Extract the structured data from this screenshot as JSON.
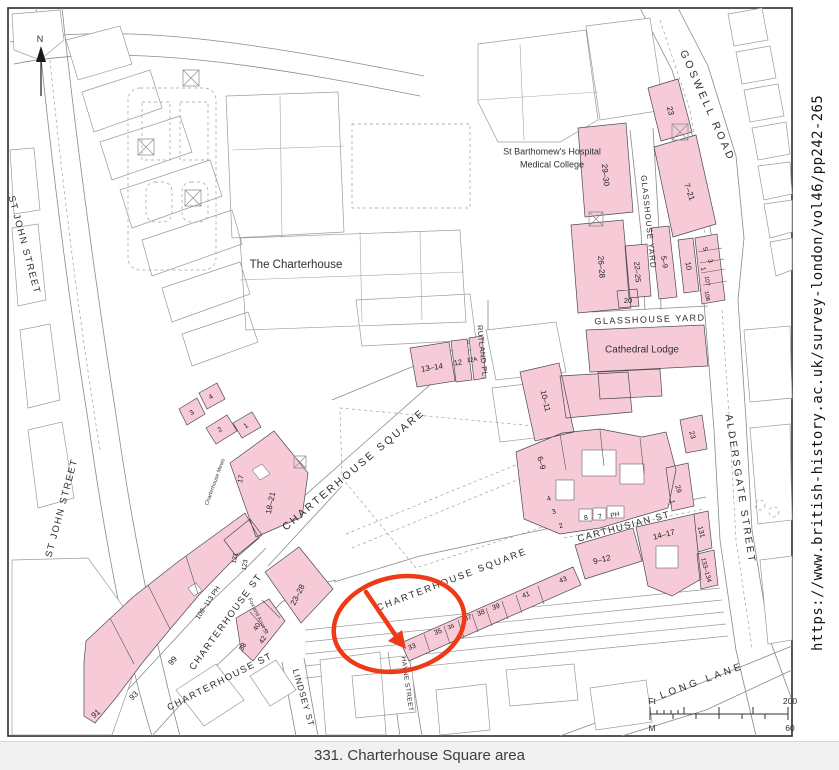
{
  "figure": {
    "caption": "331. Charterhouse Square area",
    "source_url": "https://www.british-history.ac.uk/survey-london/vol46/pp242-265"
  },
  "compass": {
    "north_label": "N"
  },
  "scale_bar": {
    "feet_unit": "Ft",
    "feet_max": "200",
    "meters_unit": "M",
    "meters_max": "60"
  },
  "colors": {
    "building_fill": "#f6cbd7",
    "annotation_red": "#ee3a17",
    "outline_gray": "#8a8a8a",
    "caption_bg": "#f1f1f2"
  },
  "map": {
    "labels": [
      {
        "t": "ST JOHN STREET",
        "x": 24,
        "y": 245,
        "r": 75,
        "s": 9.5,
        "ls": 1.5,
        "c": "st"
      },
      {
        "t": "ST JOHN STREET",
        "x": 62,
        "y": 508,
        "r": -75,
        "s": 9.5,
        "ls": 1.5,
        "c": "st"
      },
      {
        "t": "CHARTERHOUSE SQUARE",
        "x": 354,
        "y": 470,
        "r": -40,
        "s": 10.5,
        "ls": 2.5,
        "c": "st"
      },
      {
        "t": "CHARTERHOUSE SQUARE",
        "x": 452,
        "y": 580,
        "r": -21,
        "s": 9.5,
        "ls": 2,
        "c": "st"
      },
      {
        "t": "CHARTERHOUSE ST",
        "x": 226,
        "y": 622,
        "r": -54,
        "s": 9.5,
        "ls": 1.5,
        "c": "st"
      },
      {
        "t": "CHARTERHOUSE ST",
        "x": 220,
        "y": 682,
        "r": -27,
        "s": 9.5,
        "ls": 1.5,
        "c": "st"
      },
      {
        "t": "CARTHUSIAN ST",
        "x": 624,
        "y": 527,
        "r": -15,
        "s": 9.5,
        "ls": 1.5,
        "c": "st"
      },
      {
        "t": "ALDERSGATE STREET",
        "x": 740,
        "y": 489,
        "r": 81,
        "s": 10,
        "ls": 2.5,
        "c": "st"
      },
      {
        "t": "GOSWELL ROAD",
        "x": 707,
        "y": 106,
        "r": 66,
        "s": 10.5,
        "ls": 3,
        "c": "st"
      },
      {
        "t": "GLASSHOUSE YARD",
        "x": 648,
        "y": 222,
        "r": 84,
        "s": 8,
        "ls": 1,
        "c": "st"
      },
      {
        "t": "GLASSHOUSE YARD",
        "x": 650,
        "y": 320,
        "r": -2,
        "s": 9,
        "ls": 1.5,
        "c": "st"
      },
      {
        "t": "RUTLAND PL.",
        "x": 482,
        "y": 352,
        "r": 84,
        "s": 7.5,
        "ls": 0.5,
        "c": "st"
      },
      {
        "t": "LONG LANE",
        "x": 702,
        "y": 681,
        "r": -20,
        "s": 10,
        "ls": 3.5,
        "c": "st"
      },
      {
        "t": "LINDSEY ST",
        "x": 303,
        "y": 698,
        "r": 74,
        "s": 8.5,
        "ls": 1,
        "c": "st"
      },
      {
        "t": "HAYNE STREET",
        "x": 407,
        "y": 684,
        "r": 82,
        "s": 6.5,
        "ls": 0.5,
        "c": "st"
      },
      {
        "t": "Charterhouse Mews",
        "x": 215,
        "y": 482,
        "r": -70,
        "s": 5.5,
        "ls": 0,
        "c": "tiny"
      },
      {
        "t": "Fox and Knot St",
        "x": 258,
        "y": 616,
        "r": 64,
        "s": 5.5,
        "ls": 0,
        "c": "tiny"
      },
      {
        "t": "The Charterhouse",
        "x": 296,
        "y": 265,
        "r": 0,
        "s": 11.5,
        "ls": 0,
        "c": "pl"
      },
      {
        "t": "St Barthomew's Hospital",
        "x": 552,
        "y": 152,
        "r": 0,
        "s": 9,
        "ls": 0,
        "c": "pl"
      },
      {
        "t": "Medical College",
        "x": 552,
        "y": 165,
        "r": 0,
        "s": 9,
        "ls": 0,
        "c": "pl"
      },
      {
        "t": "Cathedral Lodge",
        "x": 642,
        "y": 350,
        "r": 0,
        "s": 10,
        "ls": 0,
        "c": "pl"
      },
      {
        "t": "23",
        "x": 670,
        "y": 111,
        "r": 75,
        "s": 8,
        "ls": 0,
        "c": "nm"
      },
      {
        "t": "7–21",
        "x": 689,
        "y": 192,
        "r": 70,
        "s": 8,
        "ls": 0,
        "c": "nm"
      },
      {
        "t": "29–30",
        "x": 605,
        "y": 175,
        "r": 84,
        "s": 8,
        "ls": 0,
        "c": "nm"
      },
      {
        "t": "26–28",
        "x": 601,
        "y": 267,
        "r": 86,
        "s": 8,
        "ls": 0,
        "c": "nm"
      },
      {
        "t": "22–25",
        "x": 637,
        "y": 272,
        "r": 86,
        "s": 7.5,
        "ls": 0,
        "c": "nm"
      },
      {
        "t": "20",
        "x": 628,
        "y": 301,
        "r": 0,
        "s": 7.5,
        "ls": 0,
        "c": "nm"
      },
      {
        "t": "5–9",
        "x": 664,
        "y": 262,
        "r": 80,
        "s": 7.5,
        "ls": 0,
        "c": "nm"
      },
      {
        "t": "10",
        "x": 688,
        "y": 266,
        "r": 80,
        "s": 7.5,
        "ls": 0,
        "c": "nm"
      },
      {
        "t": "5",
        "x": 705,
        "y": 249,
        "r": 80,
        "s": 6.5,
        "ls": 0,
        "c": "nm"
      },
      {
        "t": "3",
        "x": 710,
        "y": 261,
        "r": 80,
        "s": 6.5,
        "ls": 0,
        "c": "nm"
      },
      {
        "t": "1",
        "x": 703,
        "y": 269,
        "r": 80,
        "s": 6.5,
        "ls": 0,
        "c": "nm"
      },
      {
        "t": "107",
        "x": 707,
        "y": 281,
        "r": 80,
        "s": 6,
        "ls": 0,
        "c": "nm"
      },
      {
        "t": "108",
        "x": 707,
        "y": 296,
        "r": 80,
        "s": 6,
        "ls": 0,
        "c": "nm"
      },
      {
        "t": "13–14",
        "x": 432,
        "y": 368,
        "r": -9,
        "s": 8,
        "ls": 0,
        "c": "nm"
      },
      {
        "t": "12",
        "x": 458,
        "y": 363,
        "r": -9,
        "s": 7.5,
        "ls": 0,
        "c": "nm"
      },
      {
        "t": "12A",
        "x": 472,
        "y": 360,
        "r": -9,
        "s": 6,
        "ls": 0,
        "c": "nm"
      },
      {
        "t": "10–11",
        "x": 545,
        "y": 401,
        "r": 77,
        "s": 8,
        "ls": 0,
        "c": "nm"
      },
      {
        "t": "6–9",
        "x": 541,
        "y": 463,
        "r": 75,
        "s": 8,
        "ls": 0,
        "c": "nm"
      },
      {
        "t": "4",
        "x": 549,
        "y": 499,
        "r": -20,
        "s": 7,
        "ls": 0,
        "c": "nm"
      },
      {
        "t": "3",
        "x": 554,
        "y": 512,
        "r": -20,
        "s": 7,
        "ls": 0,
        "c": "nm"
      },
      {
        "t": "2",
        "x": 561,
        "y": 526,
        "r": -20,
        "s": 7,
        "ls": 0,
        "c": "nm"
      },
      {
        "t": "8",
        "x": 586,
        "y": 518,
        "r": -12,
        "s": 7,
        "ls": 0,
        "c": "nm"
      },
      {
        "t": "7",
        "x": 600,
        "y": 517,
        "r": -12,
        "s": 7,
        "ls": 0,
        "c": "nm"
      },
      {
        "t": "PH",
        "x": 615,
        "y": 515,
        "r": -12,
        "s": 6.5,
        "ls": 0,
        "c": "nm"
      },
      {
        "t": "1",
        "x": 672,
        "y": 502,
        "r": 75,
        "s": 7,
        "ls": 0,
        "c": "nm"
      },
      {
        "t": "29",
        "x": 678,
        "y": 489,
        "r": 75,
        "s": 7,
        "ls": 0,
        "c": "nm"
      },
      {
        "t": "23",
        "x": 692,
        "y": 435,
        "r": 75,
        "s": 7,
        "ls": 0,
        "c": "nm"
      },
      {
        "t": "18–21",
        "x": 271,
        "y": 503,
        "r": -78,
        "s": 8,
        "ls": 0,
        "c": "nm"
      },
      {
        "t": "17",
        "x": 241,
        "y": 479,
        "r": -78,
        "s": 7,
        "ls": 0,
        "c": "nm"
      },
      {
        "t": "1",
        "x": 246,
        "y": 426,
        "r": -35,
        "s": 7,
        "ls": 0,
        "c": "nm"
      },
      {
        "t": "2",
        "x": 220,
        "y": 430,
        "r": -35,
        "s": 7,
        "ls": 0,
        "c": "nm"
      },
      {
        "t": "3",
        "x": 192,
        "y": 413,
        "r": -35,
        "s": 7,
        "ls": 0,
        "c": "nm"
      },
      {
        "t": "4",
        "x": 211,
        "y": 397,
        "r": -35,
        "s": 7,
        "ls": 0,
        "c": "nm"
      },
      {
        "t": "121",
        "x": 235,
        "y": 558,
        "r": -80,
        "s": 6.5,
        "ls": 0,
        "c": "nm"
      },
      {
        "t": "123",
        "x": 245,
        "y": 565,
        "r": -80,
        "s": 6.5,
        "ls": 0,
        "c": "nm"
      },
      {
        "t": "109–113 PH",
        "x": 208,
        "y": 603,
        "r": -56,
        "s": 7,
        "ls": 0,
        "c": "nm"
      },
      {
        "t": "99",
        "x": 173,
        "y": 661,
        "r": -50,
        "s": 8,
        "ls": 0,
        "c": "nm"
      },
      {
        "t": "93",
        "x": 134,
        "y": 696,
        "r": -45,
        "s": 8,
        "ls": 0,
        "c": "nm"
      },
      {
        "t": "91",
        "x": 96,
        "y": 714,
        "r": -40,
        "s": 8,
        "ls": 0,
        "c": "nm"
      },
      {
        "t": "23–28",
        "x": 298,
        "y": 595,
        "r": -63,
        "s": 8,
        "ls": 0,
        "c": "nm"
      },
      {
        "t": "40",
        "x": 257,
        "y": 627,
        "r": -60,
        "s": 7,
        "ls": 0,
        "c": "nm"
      },
      {
        "t": "42",
        "x": 263,
        "y": 640,
        "r": -60,
        "s": 7,
        "ls": 0,
        "c": "nm"
      },
      {
        "t": "38",
        "x": 243,
        "y": 647,
        "r": -60,
        "s": 7,
        "ls": 0,
        "c": "nm"
      },
      {
        "t": "33",
        "x": 412,
        "y": 647,
        "r": -20,
        "s": 7,
        "ls": 0,
        "c": "nm"
      },
      {
        "t": "35",
        "x": 438,
        "y": 632,
        "r": -20,
        "s": 7,
        "ls": 0,
        "c": "nm"
      },
      {
        "t": "36",
        "x": 451,
        "y": 627,
        "r": -20,
        "s": 6,
        "ls": 0,
        "c": "nm"
      },
      {
        "t": "37",
        "x": 468,
        "y": 618,
        "r": -20,
        "s": 7,
        "ls": 0,
        "c": "nm"
      },
      {
        "t": "38",
        "x": 481,
        "y": 613,
        "r": -20,
        "s": 7,
        "ls": 0,
        "c": "nm"
      },
      {
        "t": "39",
        "x": 496,
        "y": 607,
        "r": -20,
        "s": 7,
        "ls": 0,
        "c": "nm"
      },
      {
        "t": "41",
        "x": 526,
        "y": 595,
        "r": -20,
        "s": 7,
        "ls": 0,
        "c": "nm"
      },
      {
        "t": "43",
        "x": 563,
        "y": 580,
        "r": -20,
        "s": 7,
        "ls": 0,
        "c": "nm"
      },
      {
        "t": "9–12",
        "x": 602,
        "y": 560,
        "r": -14,
        "s": 8,
        "ls": 0,
        "c": "nm"
      },
      {
        "t": "14–17",
        "x": 664,
        "y": 535,
        "r": -14,
        "s": 8,
        "ls": 0,
        "c": "nm"
      },
      {
        "t": "131",
        "x": 701,
        "y": 532,
        "r": 75,
        "s": 7,
        "ls": 0,
        "c": "nm"
      },
      {
        "t": "133–134",
        "x": 706,
        "y": 570,
        "r": 75,
        "s": 6.5,
        "ls": 0,
        "c": "nm"
      }
    ]
  }
}
